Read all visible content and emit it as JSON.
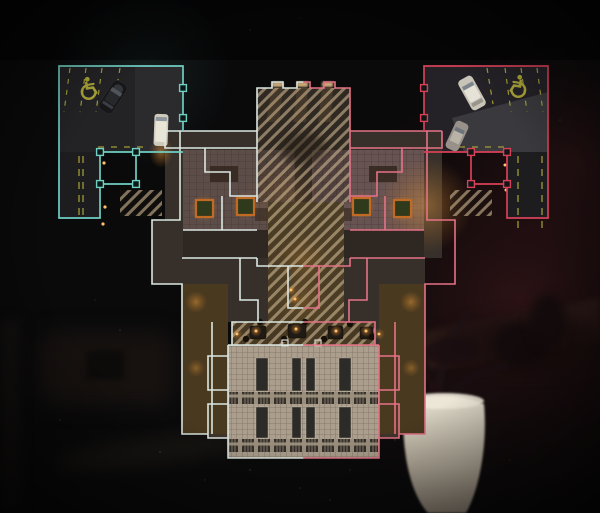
{
  "scene": {
    "type": "tactical-map-overview",
    "view": "top-down building plan over dark blurred room background"
  },
  "colors": {
    "background": "#0a0a0b",
    "background_right_tint": "#2a1214",
    "left_accent": "#6fcfc2",
    "left_wall": "#dce7e2",
    "right_accent": "#d84058",
    "right_wall": "#e57287",
    "hatch_stripe": "#cdb691",
    "atrium_glass": "#ab9e8d",
    "road_marking": "#b8b13c",
    "warm_glow": "#e08a2e",
    "candle": "#ffc06a",
    "node_fill": "#0d1715",
    "window_light": "#e3bd85"
  },
  "map": {
    "left_zone": {
      "outline_color_name": "teal",
      "parking_lot": {
        "marking_icon": "handicap-icon",
        "cars": [
          {
            "name": "dark-suv",
            "color": "#17171a"
          },
          {
            "name": "white-van",
            "color": "#cfcaba",
            "headlights_on": true
          }
        ],
        "stall_lines": "yellow-dashed"
      },
      "node_handles": 6
    },
    "right_zone": {
      "outline_color_name": "crimson",
      "parking_lot": {
        "marking_icon": "handicap-icon",
        "cars": [
          {
            "name": "white-suv",
            "color": "#c9c4b8"
          },
          {
            "name": "silver-car",
            "color": "#97918a"
          }
        ],
        "stall_lines": "yellow-dashed"
      },
      "node_handles": 6
    },
    "center": {
      "skylights": 4,
      "hatched_regions": 5,
      "atrium": {
        "panel_rows": 2,
        "panels_per_row": 4,
        "truss_rows": 2
      },
      "roof_window_slits": 3,
      "table_row_candles": 6
    },
    "background_props": [
      "couch",
      "cabinet",
      "shelf",
      "plant",
      "white-vase"
    ]
  }
}
